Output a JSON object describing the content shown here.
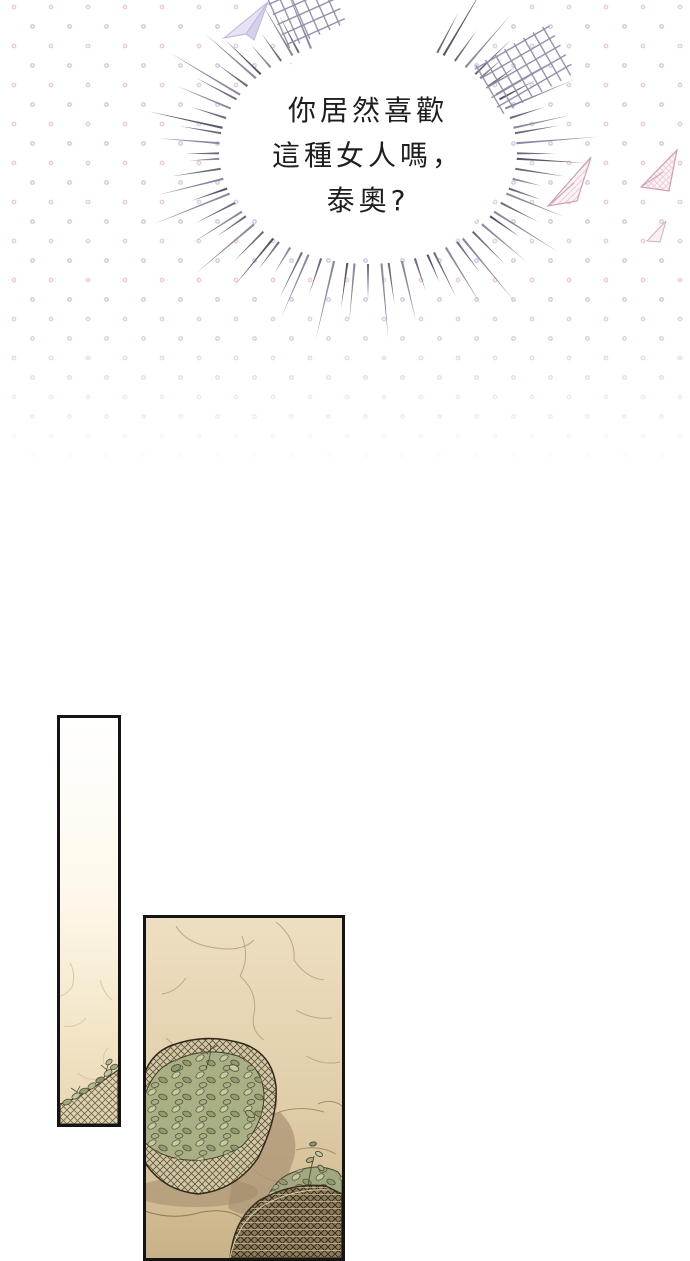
{
  "speech_bubble": {
    "lines": [
      "你居然喜歡",
      "這種女人嗎，",
      "泰奧?"
    ]
  },
  "icons": {
    "paper_plane_lavender": "paper-plane",
    "paper_plane_pink_large": "paper-plane",
    "paper_plane_pink_mid": "paper-plane",
    "paper_plane_pink_small": "paper-plane",
    "crosshatch_left": "crosshatch-doodle",
    "crosshatch_right": "crosshatch-doodle"
  },
  "colors": {
    "page_bg": "#ffffff",
    "dot_pink": "#e5c6d4",
    "dot_lavender": "#cbc1e0",
    "burst_line": "#716b7d",
    "burst_line_alt": "#8d87a0",
    "burst_line_dark": "#5a5468",
    "speech_text": "#1e1e1e",
    "panel_border": "#141414",
    "wall_light": "#efe1c3",
    "wall_dark": "#cdb68c",
    "basket_weave": "#d3c8a6",
    "basket_weave_dark": "#8d7c5c",
    "basket_stitch": "#5e5339",
    "leaf_green": "#9ba376",
    "leaf_light": "#c2c8a2",
    "shadow_tan": "#ae9778",
    "crack_line": "#bda583"
  }
}
